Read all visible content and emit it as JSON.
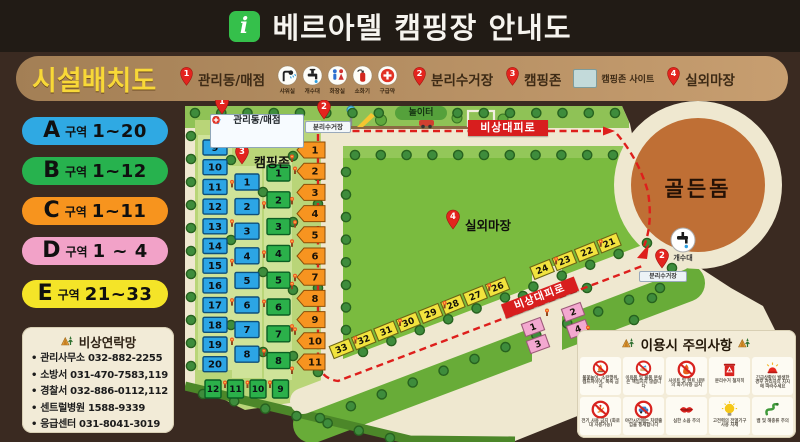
{
  "title": {
    "text": "베르아델 캠핑장 안내도",
    "info_icon": "i"
  },
  "legend": {
    "heading": "시설배치도",
    "pins": [
      {
        "num": "1",
        "label": "관리동/매점"
      },
      {
        "num": "2",
        "label": "분리수거장"
      },
      {
        "num": "3",
        "label": "캠핑존"
      },
      {
        "num": "4",
        "label": "실외마장"
      }
    ],
    "site_sample_label": "캠핑존 사이트",
    "facilities": [
      {
        "icon": "shower-icon",
        "label": "샤워실"
      },
      {
        "icon": "sink-icon",
        "label": "개수대"
      },
      {
        "icon": "toilet-icon",
        "label": "화장실"
      },
      {
        "icon": "fire-extinguisher-icon",
        "label": "소화기"
      },
      {
        "icon": "first-aid-icon",
        "label": "구급약"
      }
    ]
  },
  "zones_key": [
    {
      "zone": "A",
      "suffix": "구역",
      "range": "1~20",
      "color": "#2fa9e3"
    },
    {
      "zone": "B",
      "suffix": "구역",
      "range": "1~12",
      "color": "#27b24e"
    },
    {
      "zone": "C",
      "suffix": "구역",
      "range": "1~11",
      "color": "#f7941e"
    },
    {
      "zone": "D",
      "suffix": "구역",
      "range": "1 ~ 4",
      "color": "#f2a2c8"
    },
    {
      "zone": "E",
      "suffix": "구역",
      "range": "21~33",
      "color": "#f4e428"
    }
  ],
  "contacts": {
    "heading": "비상연락망",
    "items": [
      "관리사무소 032-882-2255",
      "소방서 031-470-7583,119",
      "경찰서 032-886-0112,112",
      "센트럴병원 1588-9339",
      "응급센터 031-8041-3019"
    ]
  },
  "map": {
    "labels": {
      "office": "관리동/매점",
      "recycle_top": "분리수거장",
      "campzone": "캠핑존",
      "playground": "놀이터",
      "evac_top": "비상대피로",
      "evac_bottom": "비상대피로",
      "field": "실외마장",
      "dome": "골든돔",
      "sink": "개수대",
      "recycle_right": "분리수거장"
    },
    "sites": {
      "a_left": [
        "9",
        "10",
        "11",
        "12",
        "13",
        "14",
        "15",
        "16",
        "17",
        "18",
        "19",
        "20"
      ],
      "a_mid": [
        "1",
        "2",
        "3",
        "4",
        "5",
        "6",
        "7",
        "8"
      ],
      "b_col": [
        "1",
        "2",
        "3",
        "4",
        "5",
        "6",
        "7",
        "8"
      ],
      "b_row": [
        "12",
        "11",
        "10",
        "9"
      ],
      "c": [
        "1",
        "2",
        "3",
        "4",
        "5",
        "6",
        "7",
        "8",
        "9",
        "10",
        "11"
      ],
      "d": [
        "1",
        "2",
        "3",
        "4"
      ],
      "e": [
        "21",
        "22",
        "23",
        "24",
        "26",
        "27",
        "28",
        "29",
        "30",
        "31",
        "32",
        "33"
      ]
    },
    "colors": {
      "site_blue": "#2ca5e5",
      "site_green": "#2bb04a",
      "site_orange": "#f79420",
      "site_yellow": "#f2e33e",
      "site_pink": "#f3a8d0",
      "route_red": "#de1f1c",
      "dome_brown": "#bf6f35",
      "field_green": "#7abb3f",
      "cream": "#efe8d0"
    }
  },
  "cautions": {
    "heading": "이용시 주의사항",
    "items": [
      {
        "icon": "no-campfire-icon",
        "text": "불꽃놀이, 소란행위, 캠프파이어, 폭죽 금지"
      },
      {
        "icon": "no-theft-icon",
        "text": "이용품 및 물품 분실은 책임지지 않습니다"
      },
      {
        "icon": "no-fire-icon",
        "text": "사이트 및 텐트 내부의 화기사용 금지"
      },
      {
        "icon": "recycle-bin-icon",
        "text": "분리수거 철저히"
      },
      {
        "icon": "siren-icon",
        "text": "긴급상황이 발생한 경우 관리자의 지시에 따라주세요"
      },
      {
        "icon": "no-fireworks-icon",
        "text": "전기 사용 금지 (화로대 사용가능)"
      },
      {
        "icon": "no-car-icon",
        "text": "야간시간에는 차량출입을 통제합니다"
      },
      {
        "icon": "quiet-icon",
        "text": "심한 소음 주의"
      },
      {
        "icon": "bulb-icon",
        "text": "고전력의 전열기구 사용 자제"
      },
      {
        "icon": "snake-icon",
        "text": "뱀 및 해충류 주의"
      }
    ]
  }
}
